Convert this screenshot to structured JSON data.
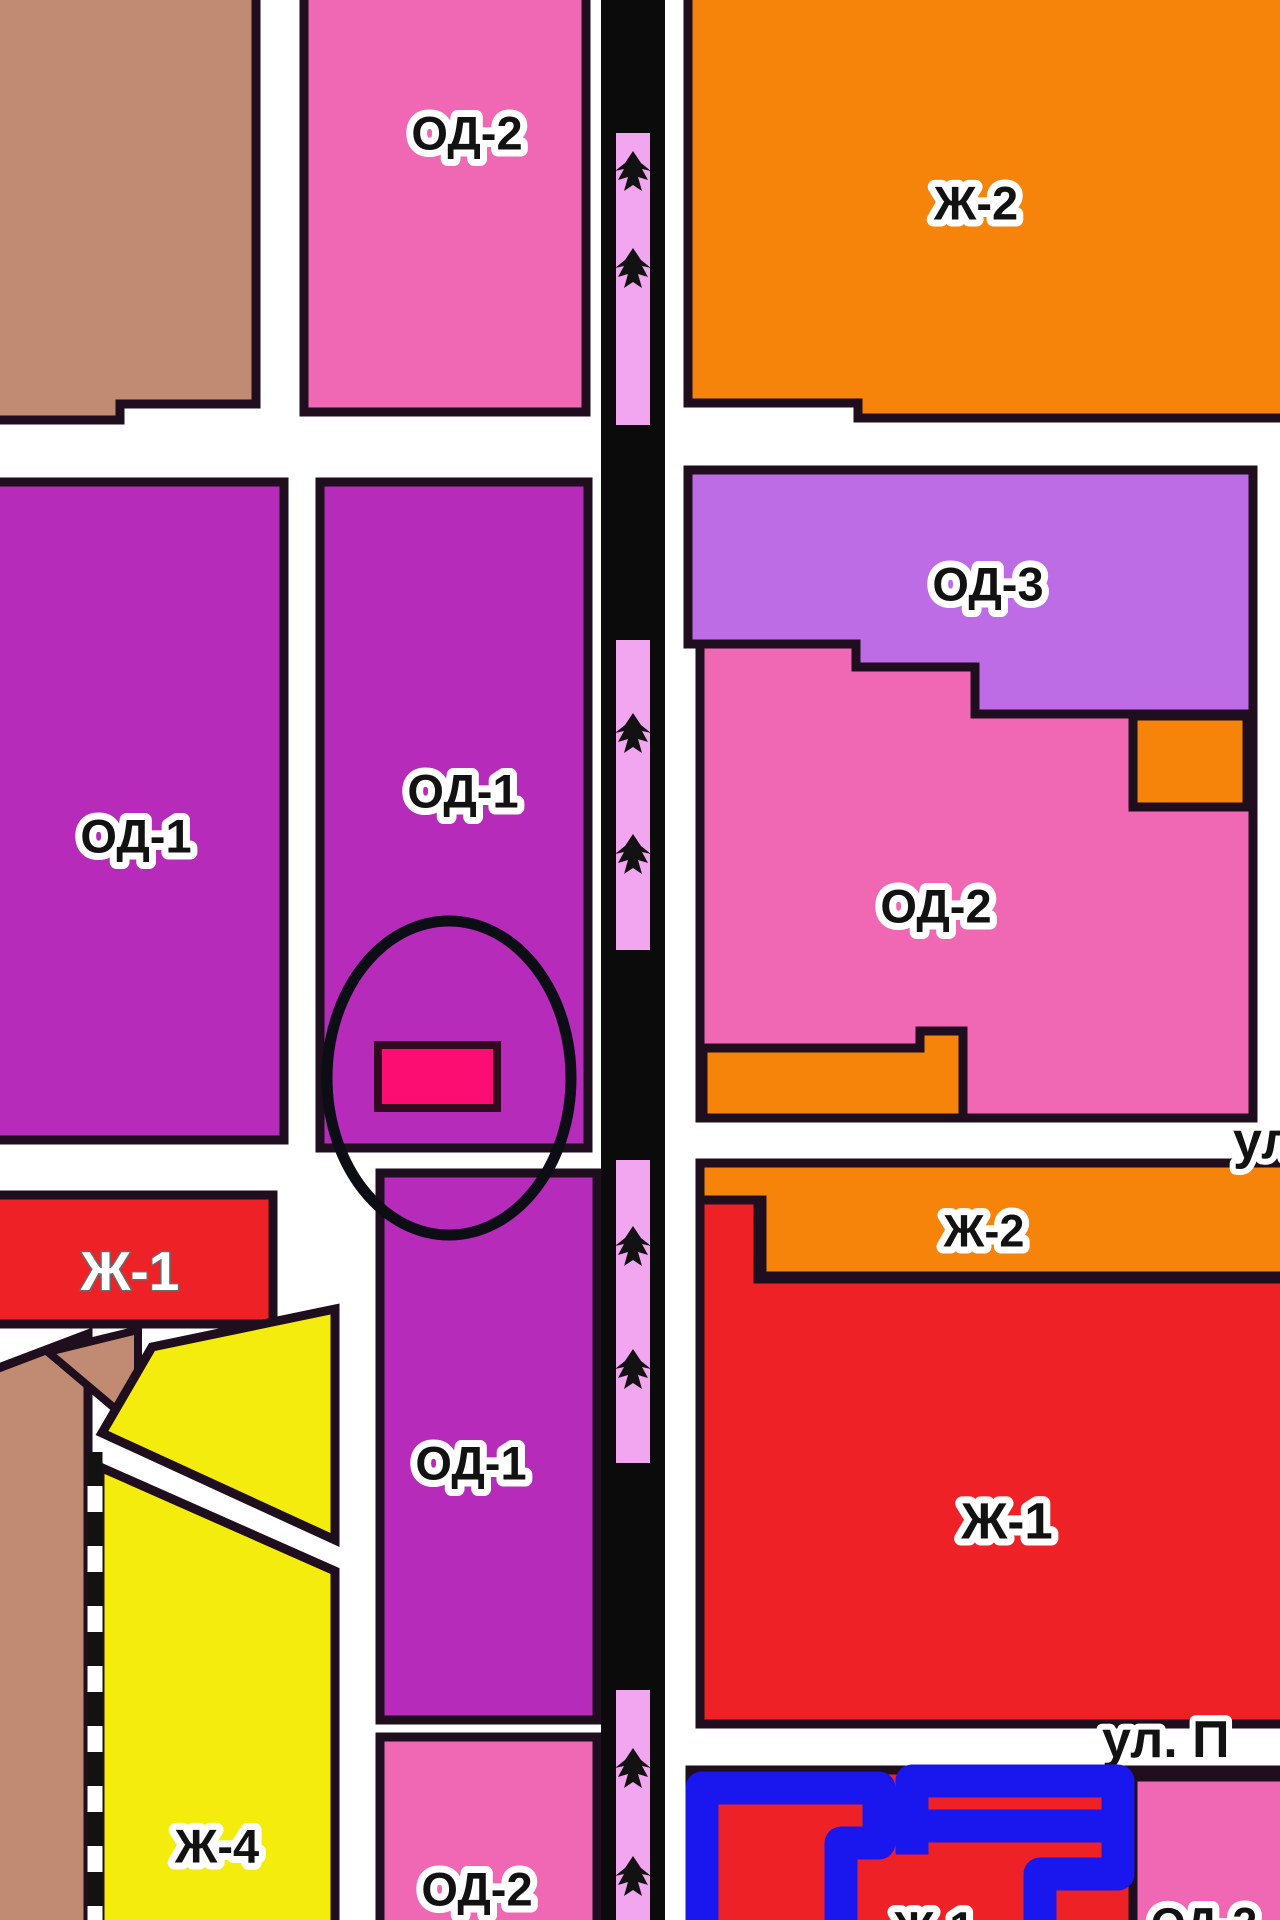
{
  "map": {
    "type": "city-zoning-plan-fragment",
    "highlight_note": "parcel highlighted with pink rectangle inside hand-drawn black ellipse"
  },
  "colors": {
    "street_white": "#ffffff",
    "border_dark": "#1e0e1e",
    "tan": "#c18b73",
    "od1_magenta": "#b62bba",
    "od2_pink": "#f068b4",
    "od3_purple": "#be6ce6",
    "zh1_red": "#ee2226",
    "zh2_orange": "#f6830a",
    "zh4_yellow": "#f4ec0c",
    "road_black": "#0b0b0b",
    "road_pink": "#f3a6f0",
    "tree_black": "#121212",
    "highlight_pink": "#fc0d72",
    "highlight_border": "#33091f",
    "ellipse_black": "#0d0d16",
    "blue_marker": "#1a16ee",
    "label_black": "#121212",
    "label_white": "#ffffff"
  },
  "zones": {
    "od2_top": {
      "label": "ОД-2"
    },
    "zh2_top": {
      "label": "Ж-2"
    },
    "od1_left": {
      "label": "ОД-1"
    },
    "od1_center": {
      "label": "ОД-1"
    },
    "od3_right": {
      "label": "ОД-3"
    },
    "od2_right": {
      "label": "ОД-2"
    },
    "zh1_left_strip": {
      "label": "Ж-1"
    },
    "zh2_right": {
      "label": "Ж-2"
    },
    "zh1_right": {
      "label": "Ж-1"
    },
    "od1_lower": {
      "label": "ОД-1"
    },
    "zh4_bottom": {
      "label": "Ж-4"
    },
    "od2_bottom": {
      "label": "ОД-2"
    },
    "od2_bottom_right_clipped": {
      "label": "ОД-2"
    },
    "zh1_bottom_clipped": {
      "label": "Ж-1"
    }
  },
  "streets": {
    "right_edge_label": "ул",
    "bottom_right_label": "ул. П"
  },
  "road": {
    "icon": "tree-icon",
    "tree_count": 8
  }
}
